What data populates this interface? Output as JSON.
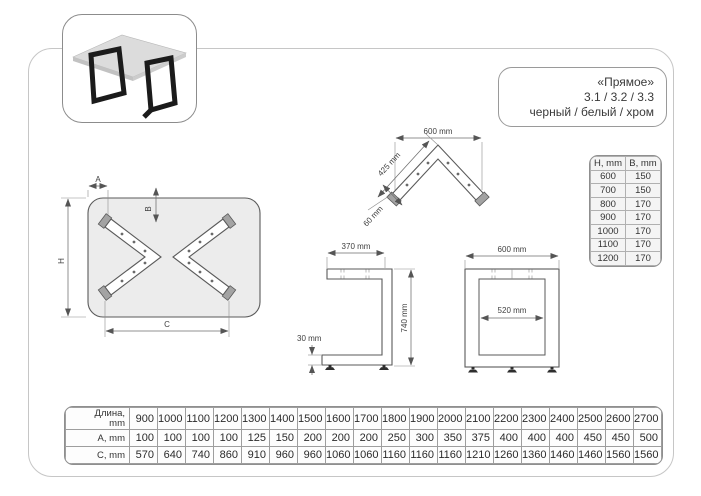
{
  "title_box": {
    "lines": [
      "«Прямое»",
      "3.1 / 3.2 / 3.3",
      "черный / белый / хром"
    ]
  },
  "drawings": {
    "top_view": {
      "label_a": "A",
      "label_b": "B",
      "label_h": "H",
      "label_c": "C"
    },
    "corner_bracket": {
      "width": "600 mm",
      "arm_length": "425 mm",
      "profile_width": "60 mm"
    },
    "side_view": {
      "top_depth": "370 mm",
      "height": "740 mm",
      "bottom_height": "30 mm"
    },
    "front_view": {
      "outer_width": "600 mm",
      "inner_width": "520 mm"
    }
  },
  "hb_table": {
    "headers": [
      "H, mm",
      "B, mm"
    ],
    "rows": [
      [
        "600",
        "150"
      ],
      [
        "700",
        "150"
      ],
      [
        "800",
        "170"
      ],
      [
        "900",
        "170"
      ],
      [
        "1000",
        "170"
      ],
      [
        "1100",
        "170"
      ],
      [
        "1200",
        "170"
      ]
    ]
  },
  "size_table": {
    "length_label_line1": "Длина,",
    "length_label_line2": "mm",
    "a_label": "A, mm",
    "c_label": "C, mm",
    "lengths": [
      "900",
      "1000",
      "1100",
      "1200",
      "1300",
      "1400",
      "1500",
      "1600",
      "1700",
      "1800",
      "1900",
      "2000",
      "2100",
      "2200",
      "2300",
      "2400",
      "2500",
      "2600",
      "2700"
    ],
    "a_values": [
      "100",
      "100",
      "100",
      "100",
      "125",
      "150",
      "200",
      "200",
      "200",
      "250",
      "300",
      "350",
      "375",
      "400",
      "400",
      "400",
      "450",
      "450",
      "500"
    ],
    "c_values": [
      "570",
      "640",
      "740",
      "860",
      "910",
      "960",
      "960",
      "1060",
      "1060",
      "1160",
      "1160",
      "1160",
      "1210",
      "1260",
      "1360",
      "1460",
      "1460",
      "1560",
      "1560"
    ]
  }
}
